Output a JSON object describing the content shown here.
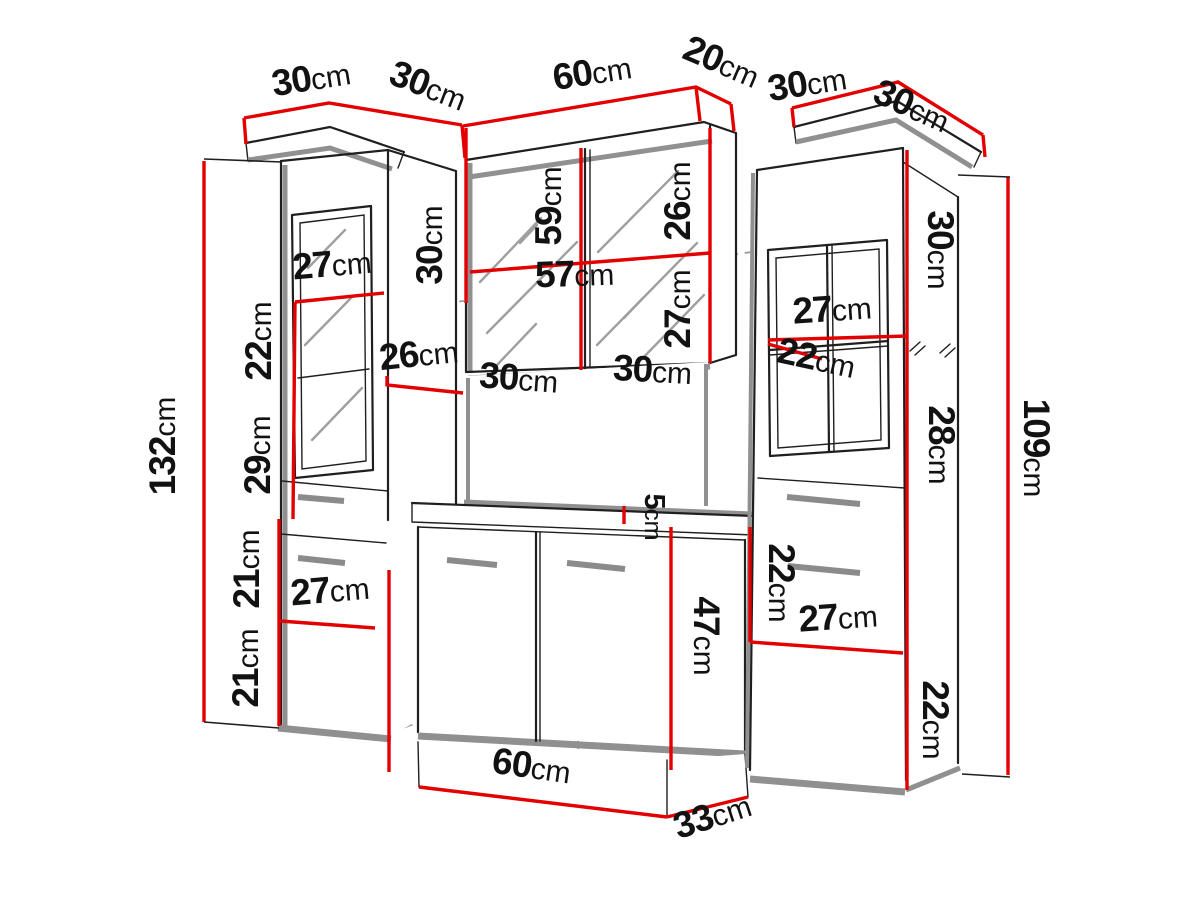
{
  "diagram": {
    "kind": "furniture-dimension-diagram",
    "unit": "cm"
  },
  "colors": {
    "dimension_red": "#e30000",
    "outline_black": "#1f1f1f",
    "shadow_gray": "#909090",
    "hidden_dash_gray": "#9a9a9a",
    "label_black": "#121212",
    "background": "#ffffff"
  },
  "labels": [
    {
      "name": "top-left-cabinet-width",
      "num": "30",
      "unit": "cm"
    },
    {
      "name": "top-left-cabinet-depth",
      "num": "30",
      "unit": "cm"
    },
    {
      "name": "top-mirror-cabinet-width",
      "num": "60",
      "unit": "cm"
    },
    {
      "name": "top-mirror-cabinet-depth",
      "num": "20",
      "unit": "cm"
    },
    {
      "name": "top-right-cabinet-width",
      "num": "30",
      "unit": "cm"
    },
    {
      "name": "top-right-cabinet-depth",
      "num": "30",
      "unit": "cm"
    },
    {
      "name": "left-cabinet-height",
      "num": "132",
      "unit": "cm"
    },
    {
      "name": "left-cabinet-shelf-width",
      "num": "27",
      "unit": "cm"
    },
    {
      "name": "left-cabinet-section-22",
      "num": "22",
      "unit": "cm"
    },
    {
      "name": "left-cabinet-section-29",
      "num": "29",
      "unit": "cm"
    },
    {
      "name": "left-cabinet-section-21a",
      "num": "21",
      "unit": "cm"
    },
    {
      "name": "left-cabinet-section-21b",
      "num": "21",
      "unit": "cm"
    },
    {
      "name": "left-cabinet-lower-shelf-width",
      "num": "27",
      "unit": "cm"
    },
    {
      "name": "left-cabinet-depth-26",
      "num": "26",
      "unit": "cm"
    },
    {
      "name": "mirror-cabinet-side-30",
      "num": "30",
      "unit": "cm"
    },
    {
      "name": "mirror-cabinet-door-59",
      "num": "59",
      "unit": "cm"
    },
    {
      "name": "mirror-cabinet-section-26",
      "num": "26",
      "unit": "cm"
    },
    {
      "name": "mirror-cabinet-inner-width-57",
      "num": "57",
      "unit": "cm"
    },
    {
      "name": "mirror-cabinet-section-27",
      "num": "27",
      "unit": "cm"
    },
    {
      "name": "mirror-cabinet-door-width-left",
      "num": "30",
      "unit": "cm"
    },
    {
      "name": "mirror-cabinet-door-width-right",
      "num": "30",
      "unit": "cm"
    },
    {
      "name": "vanity-countertop-5",
      "num": "5",
      "unit": "cm"
    },
    {
      "name": "vanity-height-47",
      "num": "47",
      "unit": "cm"
    },
    {
      "name": "vanity-width-60",
      "num": "60",
      "unit": "cm"
    },
    {
      "name": "vanity-depth-33",
      "num": "33",
      "unit": "cm"
    },
    {
      "name": "right-cabinet-shelf-27",
      "num": "27",
      "unit": "cm"
    },
    {
      "name": "right-cabinet-depth-22",
      "num": "22",
      "unit": "cm"
    },
    {
      "name": "right-cabinet-section-30",
      "num": "30",
      "unit": "cm"
    },
    {
      "name": "right-cabinet-section-28",
      "num": "28",
      "unit": "cm"
    },
    {
      "name": "right-cabinet-section-22a",
      "num": "22",
      "unit": "cm"
    },
    {
      "name": "right-cabinet-lower-shelf-27",
      "num": "27",
      "unit": "cm"
    },
    {
      "name": "right-cabinet-section-22b",
      "num": "22",
      "unit": "cm"
    },
    {
      "name": "right-cabinet-height",
      "num": "109",
      "unit": "cm"
    }
  ]
}
